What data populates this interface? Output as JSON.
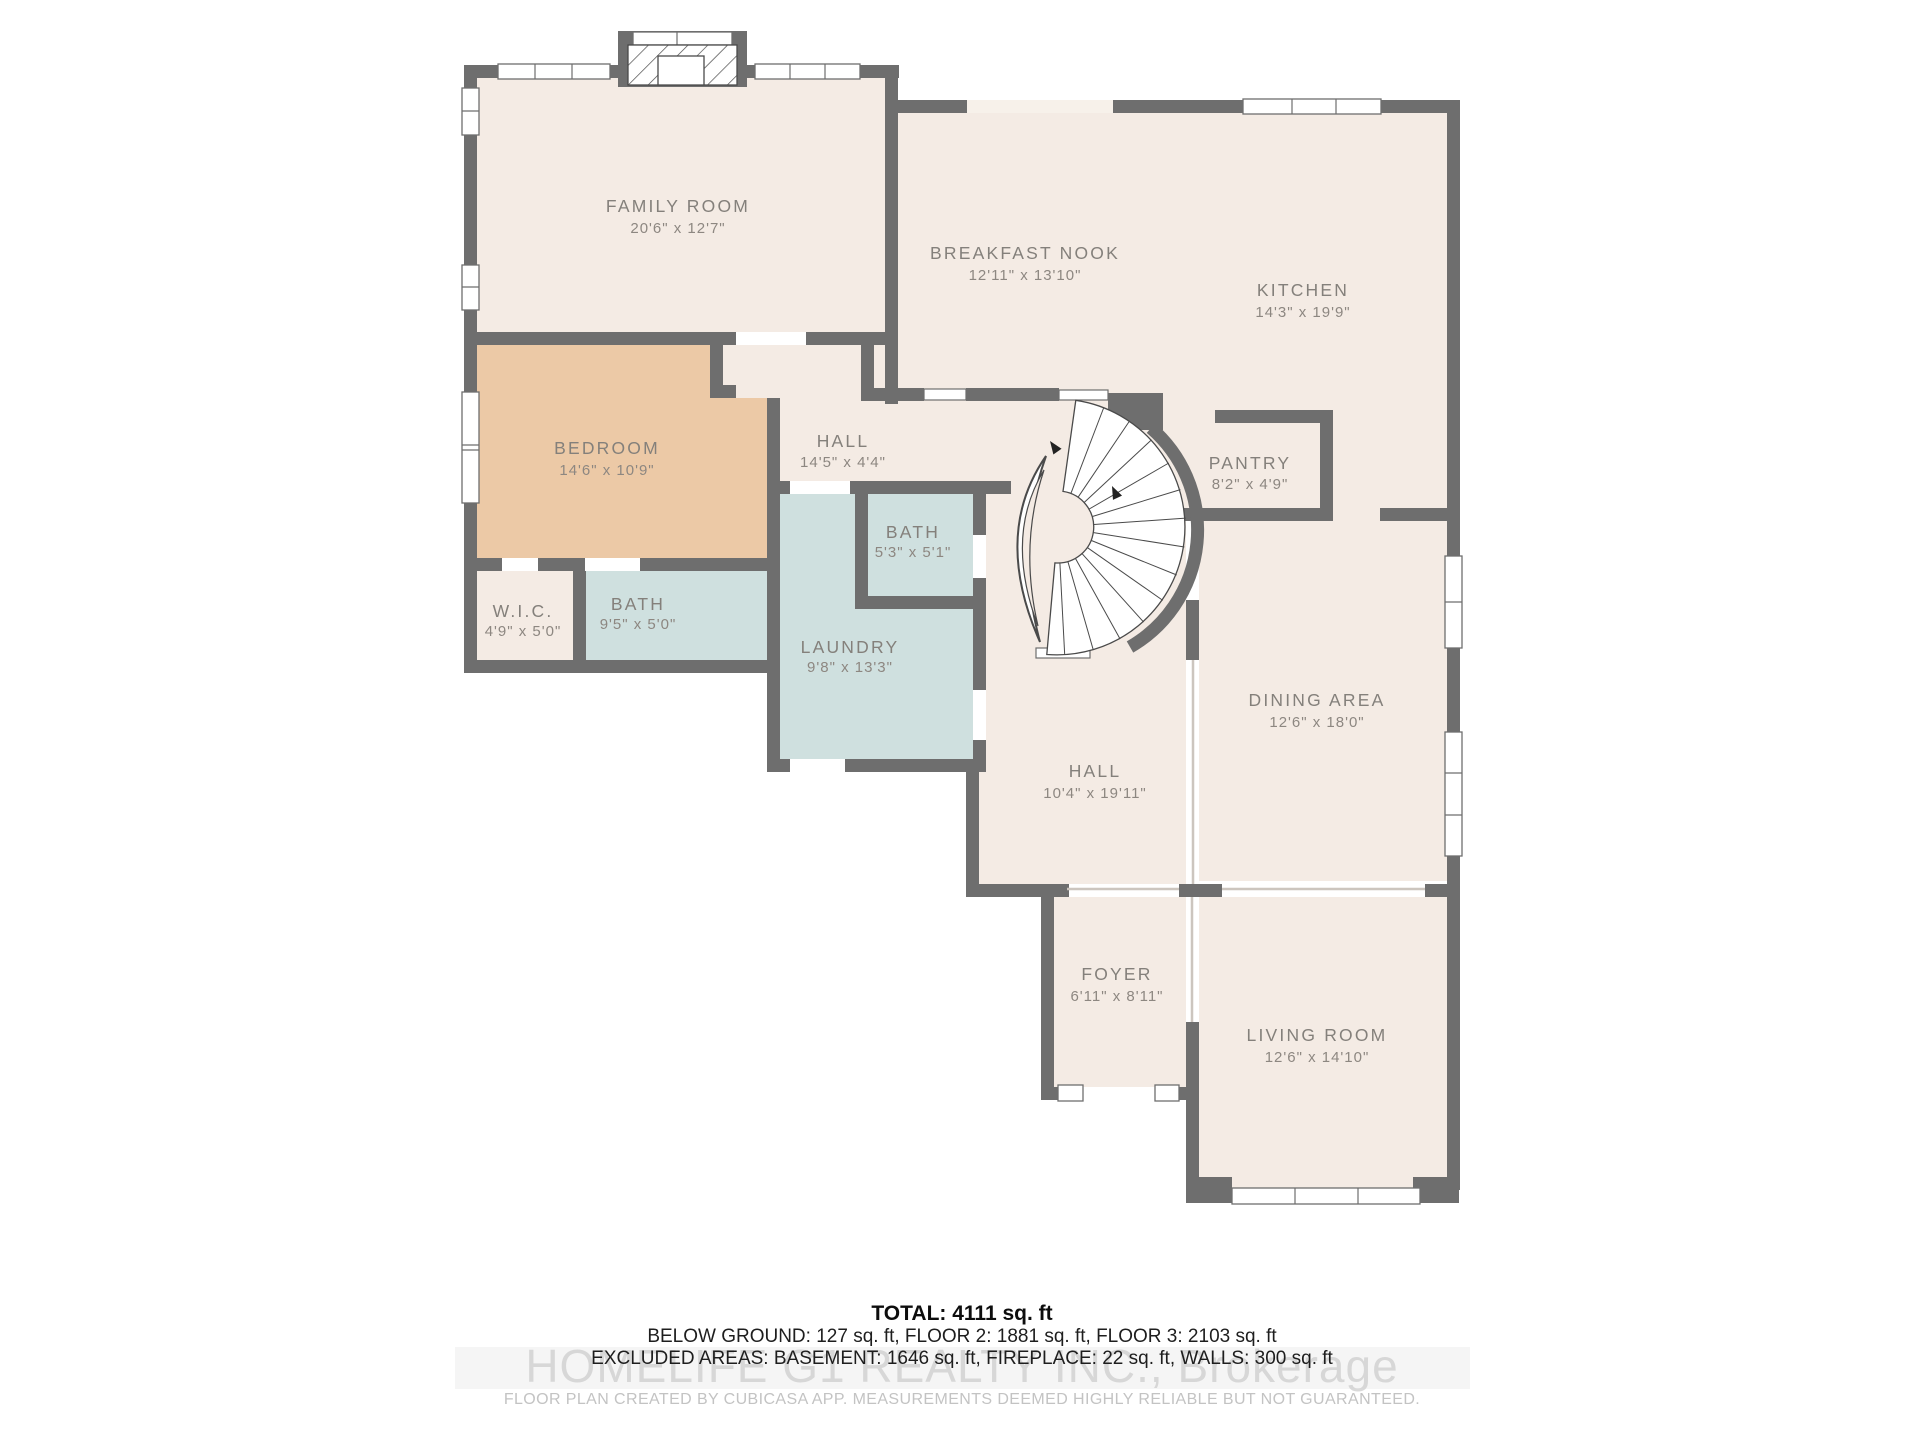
{
  "floor_plan": {
    "rooms": [
      {
        "id": "family-room",
        "name": "FAMILY ROOM",
        "dims": "20'6\" x 12'7\""
      },
      {
        "id": "breakfast-nook",
        "name": "BREAKFAST NOOK",
        "dims": "12'11\" x 13'10\""
      },
      {
        "id": "kitchen",
        "name": "KITCHEN",
        "dims": "14'3\" x 19'9\""
      },
      {
        "id": "bedroom",
        "name": "BEDROOM",
        "dims": "14'6\" x 10'9\""
      },
      {
        "id": "hall-upper",
        "name": "HALL",
        "dims": "14'5\" x 4'4\""
      },
      {
        "id": "pantry",
        "name": "PANTRY",
        "dims": "8'2\" x 4'9\""
      },
      {
        "id": "bath-small",
        "name": "BATH",
        "dims": "5'3\" x 5'1\""
      },
      {
        "id": "wic",
        "name": "W.I.C.",
        "dims": "4'9\" x 5'0\""
      },
      {
        "id": "bath",
        "name": "BATH",
        "dims": "9'5\" x 5'0\""
      },
      {
        "id": "laundry",
        "name": "LAUNDRY",
        "dims": "9'8\" x 13'3\""
      },
      {
        "id": "dining-area",
        "name": "DINING AREA",
        "dims": "12'6\" x 18'0\""
      },
      {
        "id": "hall-lower",
        "name": "HALL",
        "dims": "10'4\" x 19'11\""
      },
      {
        "id": "foyer",
        "name": "FOYER",
        "dims": "6'11\" x 8'11\""
      },
      {
        "id": "living-room",
        "name": "LIVING ROOM",
        "dims": "12'6\" x 14'10\""
      }
    ],
    "summary": {
      "total": "TOTAL: 4111 sq. ft",
      "floors": "BELOW GROUND: 127 sq. ft, FLOOR 2: 1881 sq. ft, FLOOR 3: 2103 sq. ft",
      "excluded": "EXCLUDED AREAS: BASEMENT: 1646 sq. ft, FIREPLACE: 22 sq. ft, WALLS: 300 sq. ft"
    },
    "watermark": "HOMELIFE G1 REALTY INC., Brokerage",
    "disclaimer": "FLOOR PLAN CREATED BY CUBICASA APP. MEASUREMENTS DEEMED HIGHLY RELIABLE BUT NOT GUARANTEED.",
    "colors": {
      "wall": "#6e6e6e",
      "floor": "#f4ebe4",
      "bedroom_floor": "#ecc9a6",
      "wet_room_floor": "#cfe0df"
    }
  }
}
